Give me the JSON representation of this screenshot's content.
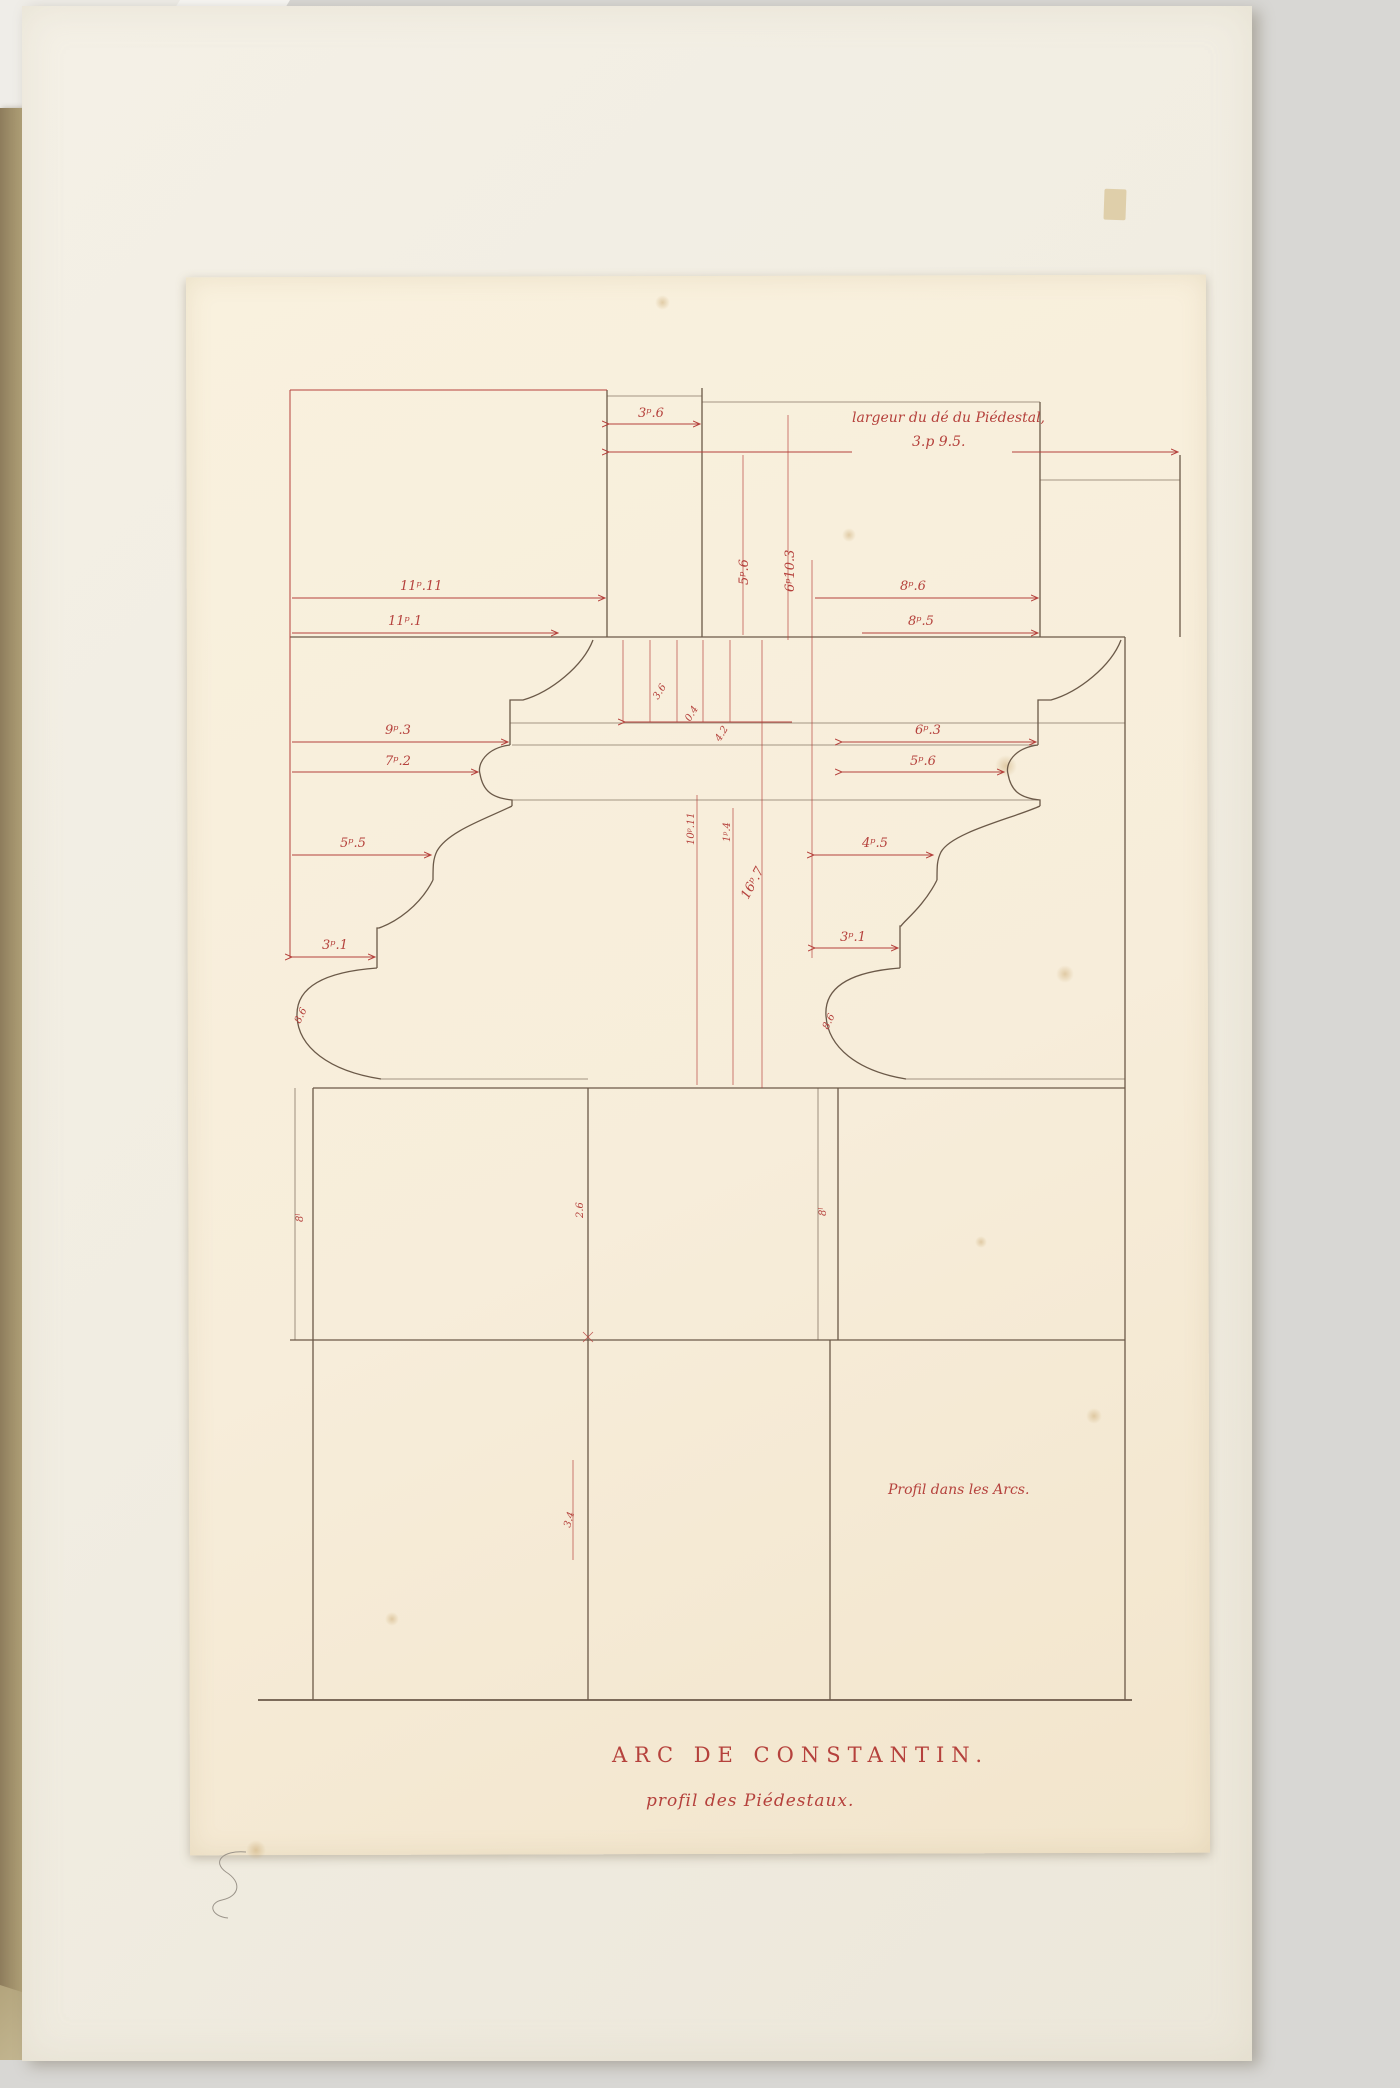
{
  "colors": {
    "ink_red": "#b5413c",
    "ink_dark": "#6b5948",
    "paper": "#f7edda",
    "page": "#f2eee4",
    "backdrop": "#d8d7d4",
    "board": "#9a8a6a"
  },
  "plate": {
    "title": "ARC DE CONSTANTIN.",
    "subtitle": "profil des Piédestaux.",
    "note_top_line1": "largeur du dé du Piédestal,",
    "note_top_line2": "3.p 9.5.",
    "note_right": "Profil dans les Arcs."
  },
  "labels": {
    "w_upper": "3ᵖ.6",
    "w_cornice_l": "11ᵖ.11",
    "w_cornice_r": "8ᵖ.6",
    "w_cornice2_l": "11ᵖ.1",
    "w_cornice2_r": "8ᵖ.5",
    "w_fillet_l": "9ᵖ.3",
    "w_fillet_r": "6ᵖ.3",
    "w_torus_l": "7ᵖ.2",
    "w_torus_r": "5ᵖ.6",
    "w_cyma_l": "5ᵖ.5",
    "w_cyma_r": "4ᵖ.5",
    "w_step_l": "3ᵖ.1",
    "w_step_r": "3ᵖ.1",
    "h_shaft": "5ᵖ.6",
    "h_base": "6ᵖ10.3",
    "h_cap1": "3.6",
    "h_cap2": "0.4",
    "h_cap3": "4.2",
    "h_mid1": "10ᵖ.11",
    "h_mid2": "1ᵖ.4",
    "h_mid3": "16ᵖ.7",
    "torus_l": "8.6",
    "torus_r": "8.6",
    "die_l": "8ˡ",
    "die_c": "2.6",
    "die_r": "8ˡ",
    "joint_c": "3.4"
  }
}
